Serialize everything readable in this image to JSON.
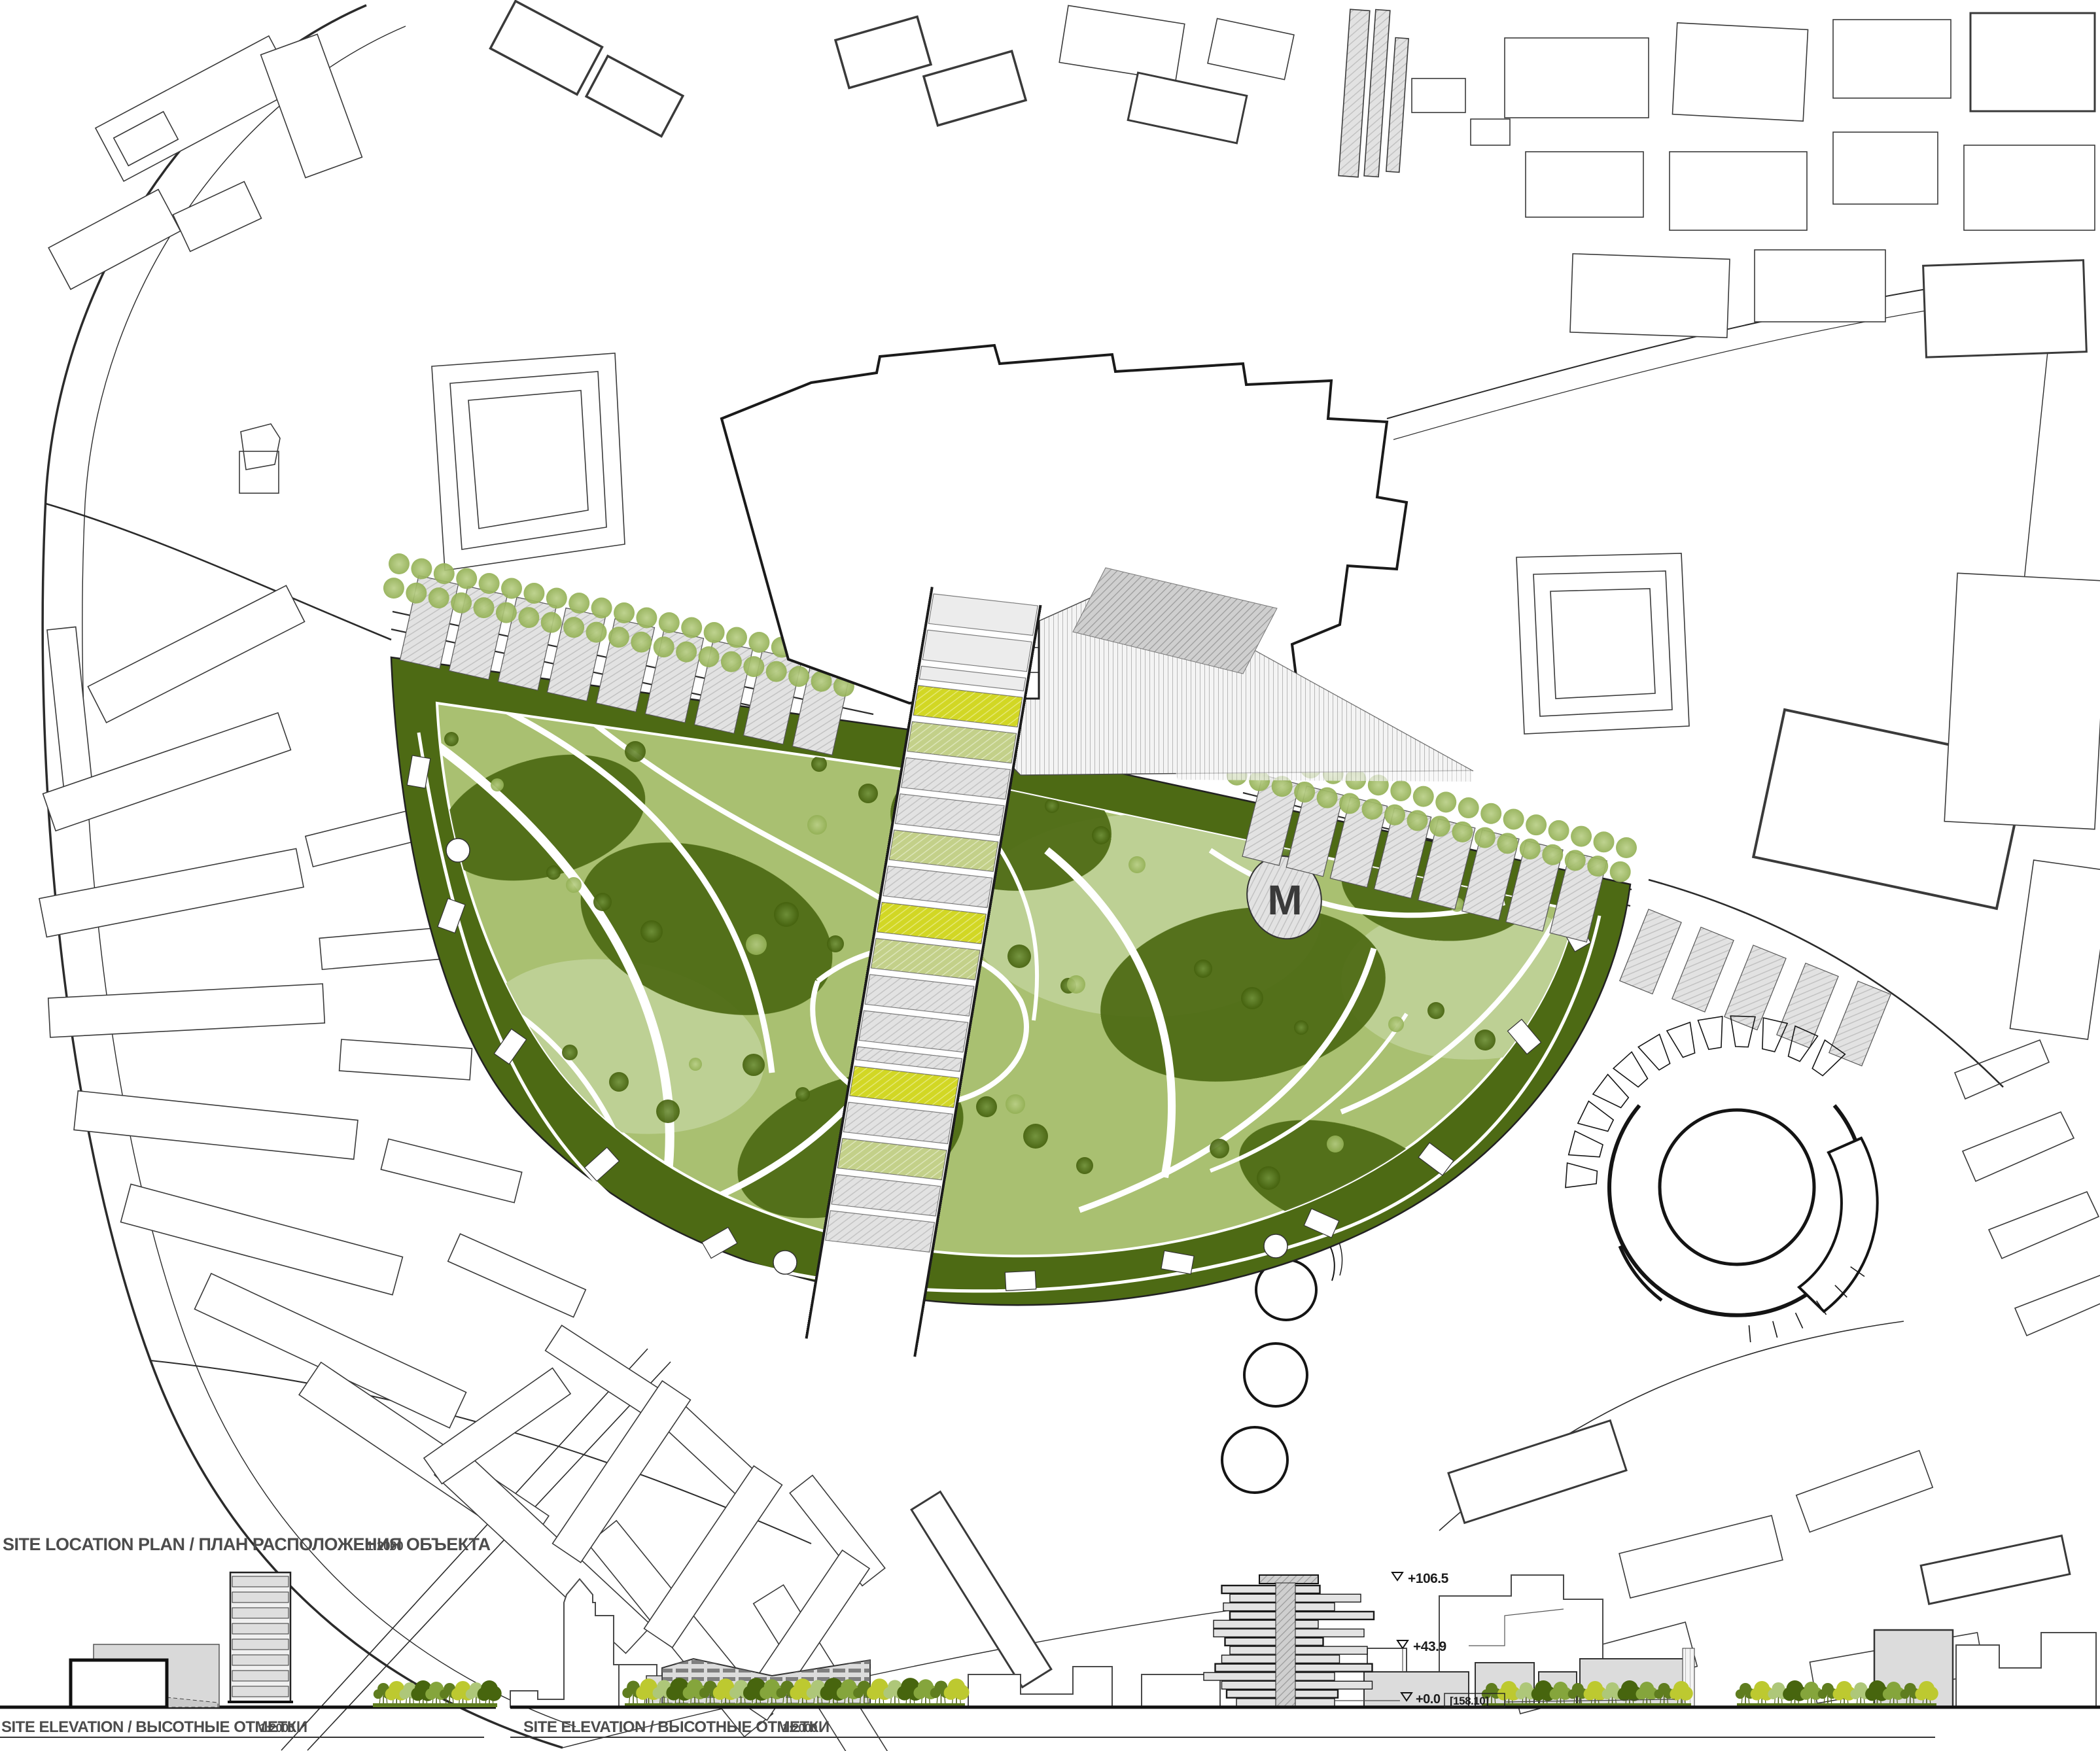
{
  "plan": {
    "label": "SITE LOCATION PLAN /  ПЛАН РАСПОЛОЖЕНИЯ ОБЪЕКТА",
    "scale": "1:2000",
    "logo_letter": "M"
  },
  "elevation_left": {
    "label": "SITE ELEVATION / ВЫСОТНЫЕ ОТМЕТКИ",
    "scale": "1:2000"
  },
  "elevation_right": {
    "label": "SITE ELEVATION / ВЫСОТНЫЕ ОТМЕТКИ",
    "scale": "1:2000"
  },
  "annotations": {
    "top": "+106.5",
    "mid": "+43.9",
    "ground": "+0.0",
    "datum": "[158.10]"
  },
  "colors": {
    "park_green": "#a9c071",
    "park_light": "#bdd094",
    "park_dark": "#4d6a14",
    "tree_row": "#9cb869",
    "stripe_yellow": "#d2d724",
    "stripe_green": "#c3d089",
    "paving_gray": "#e0e0e0",
    "building_gray": "#dcdcdc",
    "line_dark": "#1c1c1c",
    "elev_olive": "#5f7d1f",
    "elev_yellowgreen": "#bdc930",
    "elev_sage": "#aec779"
  }
}
